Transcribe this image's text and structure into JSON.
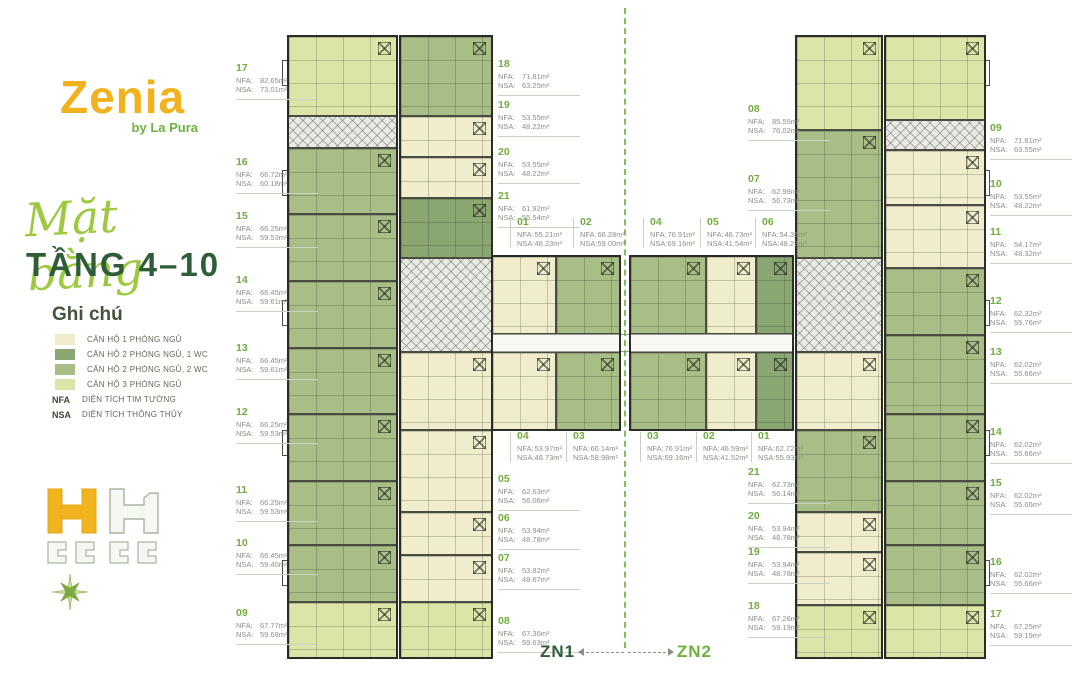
{
  "sidebar": {
    "logo": {
      "name": "Zenia",
      "byline": "by La Pura"
    },
    "title_script": "Mặt bằng",
    "title_main": "TẦNG 4–10",
    "legend": {
      "heading": "Ghi chú",
      "items": [
        {
          "label": "CĂN HỘ 1 PHÒNG NGỦ",
          "color": "#EFEDCB"
        },
        {
          "label": "CĂN HỘ 2 PHÒNG NGỦ, 1 WC",
          "color": "#8AA771"
        },
        {
          "label": "CĂN HỘ 2 PHÒNG NGỦ, 2 WC",
          "color": "#A9BE87"
        },
        {
          "label": "CĂN HỘ 3 PHÒNG NGỦ",
          "color": "#DCE4A8"
        }
      ],
      "abbreviations": [
        {
          "key": "NFA",
          "label": "DIỆN TÍCH TIM TƯỜNG"
        },
        {
          "key": "NSA",
          "label": "DIỆN TÍCH THÔNG THỦY"
        }
      ]
    }
  },
  "zones": {
    "left_label": "ZN1",
    "right_label": "ZN2"
  },
  "plan": {
    "nfa_key": "NFA:",
    "nsa_key": "NSA:",
    "unit_labels": [
      {
        "zone": "zn1",
        "id": "17",
        "nfa": "82.65m²",
        "nsa": "73.01m²",
        "x": 236,
        "y": 64,
        "s": "side"
      },
      {
        "zone": "zn1",
        "id": "16",
        "nfa": "66.72m²",
        "nsa": "60.18m²",
        "x": 236,
        "y": 158,
        "s": "side"
      },
      {
        "zone": "zn1",
        "id": "15",
        "nfa": "66.25m²",
        "nsa": "59.53m²",
        "x": 236,
        "y": 212,
        "s": "side"
      },
      {
        "zone": "zn1",
        "id": "14",
        "nfa": "66.45m²",
        "nsa": "59.61m²",
        "x": 236,
        "y": 276,
        "s": "side"
      },
      {
        "zone": "zn1",
        "id": "13",
        "nfa": "66.45m²",
        "nsa": "59.61m²",
        "x": 236,
        "y": 344,
        "s": "side"
      },
      {
        "zone": "zn1",
        "id": "12",
        "nfa": "66.25m²",
        "nsa": "59.53m²",
        "x": 236,
        "y": 408,
        "s": "side"
      },
      {
        "zone": "zn1",
        "id": "11",
        "nfa": "66.25m²",
        "nsa": "59.53m²",
        "x": 236,
        "y": 486,
        "s": "side"
      },
      {
        "zone": "zn1",
        "id": "10",
        "nfa": "66.45m²",
        "nsa": "59.40m²",
        "x": 236,
        "y": 539,
        "s": "side"
      },
      {
        "zone": "zn1",
        "id": "09",
        "nfa": "67.77m²",
        "nsa": "59.68m²",
        "x": 236,
        "y": 609,
        "s": "side"
      },
      {
        "zone": "zn1",
        "id": "18",
        "nfa": "71.81m²",
        "nsa": "63.25m²",
        "x": 498,
        "y": 60,
        "s": "side"
      },
      {
        "zone": "zn1",
        "id": "19",
        "nfa": "53.55m²",
        "nsa": "48.22m²",
        "x": 498,
        "y": 101,
        "s": "side"
      },
      {
        "zone": "zn1",
        "id": "20",
        "nfa": "53.55m²",
        "nsa": "48.22m²",
        "x": 498,
        "y": 148,
        "s": "side"
      },
      {
        "zone": "zn1",
        "id": "21",
        "nfa": "61.92m²",
        "nsa": "55.54m²",
        "x": 498,
        "y": 192,
        "s": "side"
      },
      {
        "zone": "zn1",
        "id": "01",
        "nfa": "55.21m²",
        "nsa": "48.23m²",
        "x": 510,
        "y": 218,
        "s": "center"
      },
      {
        "zone": "zn1",
        "id": "02",
        "nfa": "66.28m²",
        "nsa": "59.00m²",
        "x": 573,
        "y": 218,
        "s": "center"
      },
      {
        "zone": "zn1",
        "id": "04",
        "nfa": "53.97m²",
        "nsa": "48.73m²",
        "x": 510,
        "y": 432,
        "s": "center"
      },
      {
        "zone": "zn1",
        "id": "03",
        "nfa": "66.14m²",
        "nsa": "58.98m²",
        "x": 566,
        "y": 432,
        "s": "center"
      },
      {
        "zone": "zn1",
        "id": "05",
        "nfa": "62.63m²",
        "nsa": "56.06m²",
        "x": 498,
        "y": 475,
        "s": "side"
      },
      {
        "zone": "zn1",
        "id": "06",
        "nfa": "53.94m²",
        "nsa": "48.78m²",
        "x": 498,
        "y": 514,
        "s": "side"
      },
      {
        "zone": "zn1",
        "id": "07",
        "nfa": "53.82m²",
        "nsa": "48.67m²",
        "x": 498,
        "y": 554,
        "s": "side"
      },
      {
        "zone": "zn1",
        "id": "08",
        "nfa": "67.36m²",
        "nsa": "59.63m²",
        "x": 498,
        "y": 617,
        "s": "side"
      },
      {
        "zone": "zn2",
        "id": "04",
        "nfa": "76.91m²",
        "nsa": "69.16m²",
        "x": 643,
        "y": 218,
        "s": "center"
      },
      {
        "zone": "zn2",
        "id": "05",
        "nfa": "46.73m²",
        "nsa": "41.54m²",
        "x": 700,
        "y": 218,
        "s": "center"
      },
      {
        "zone": "zn2",
        "id": "06",
        "nfa": "54.35m²",
        "nsa": "48.23m²",
        "x": 755,
        "y": 218,
        "s": "center"
      },
      {
        "zone": "zn2",
        "id": "03",
        "nfa": "76.91m²",
        "nsa": "69.16m²",
        "x": 640,
        "y": 432,
        "s": "center"
      },
      {
        "zone": "zn2",
        "id": "02",
        "nfa": "46.59m²",
        "nsa": "41.52m²",
        "x": 696,
        "y": 432,
        "s": "center"
      },
      {
        "zone": "zn2",
        "id": "01",
        "nfa": "62.72m²",
        "nsa": "55.93m²",
        "x": 751,
        "y": 432,
        "s": "center"
      },
      {
        "zone": "zn2",
        "id": "08",
        "nfa": "85.55m²",
        "nsa": "76.02m²",
        "x": 748,
        "y": 105,
        "s": "side"
      },
      {
        "zone": "zn2",
        "id": "07",
        "nfa": "62.98m²",
        "nsa": "56.73m²",
        "x": 748,
        "y": 175,
        "s": "side"
      },
      {
        "zone": "zn2",
        "id": "21",
        "nfa": "62.73m²",
        "nsa": "56.14m²",
        "x": 748,
        "y": 468,
        "s": "side"
      },
      {
        "zone": "zn2",
        "id": "20",
        "nfa": "53.94m²",
        "nsa": "48.78m²",
        "x": 748,
        "y": 512,
        "s": "side"
      },
      {
        "zone": "zn2",
        "id": "19",
        "nfa": "53.94m²",
        "nsa": "48.78m²",
        "x": 748,
        "y": 548,
        "s": "side"
      },
      {
        "zone": "zn2",
        "id": "18",
        "nfa": "67.26m²",
        "nsa": "59.19m²",
        "x": 748,
        "y": 602,
        "s": "side"
      },
      {
        "zone": "zn2",
        "id": "09",
        "nfa": "71.81m²",
        "nsa": "63.55m²",
        "x": 990,
        "y": 124,
        "s": "side"
      },
      {
        "zone": "zn2",
        "id": "10",
        "nfa": "53.55m²",
        "nsa": "48.22m²",
        "x": 990,
        "y": 180,
        "s": "side"
      },
      {
        "zone": "zn2",
        "id": "11",
        "nfa": "54.17m²",
        "nsa": "48.32m²",
        "x": 990,
        "y": 228,
        "s": "side"
      },
      {
        "zone": "zn2",
        "id": "12",
        "nfa": "62.32m²",
        "nsa": "55.76m²",
        "x": 990,
        "y": 297,
        "s": "side"
      },
      {
        "zone": "zn2",
        "id": "13",
        "nfa": "62.02m²",
        "nsa": "55.66m²",
        "x": 990,
        "y": 348,
        "s": "side"
      },
      {
        "zone": "zn2",
        "id": "14",
        "nfa": "62.02m²",
        "nsa": "55.66m²",
        "x": 990,
        "y": 428,
        "s": "side"
      },
      {
        "zone": "zn2",
        "id": "15",
        "nfa": "62.02m²",
        "nsa": "55.66m²",
        "x": 990,
        "y": 479,
        "s": "side"
      },
      {
        "zone": "zn2",
        "id": "16",
        "nfa": "62.02m²",
        "nsa": "55.66m²",
        "x": 990,
        "y": 558,
        "s": "side"
      },
      {
        "zone": "zn2",
        "id": "17",
        "nfa": "67.25m²",
        "nsa": "59.19m²",
        "x": 990,
        "y": 610,
        "s": "side"
      }
    ],
    "blocks": [
      {
        "x": 288,
        "y": 36,
        "w": 109,
        "h": 80,
        "t": "u3"
      },
      {
        "x": 288,
        "y": 116,
        "w": 109,
        "h": 32,
        "t": "core"
      },
      {
        "x": 288,
        "y": 148,
        "w": 109,
        "h": 66,
        "t": "u2b"
      },
      {
        "x": 288,
        "y": 214,
        "w": 109,
        "h": 67,
        "t": "u2b"
      },
      {
        "x": 288,
        "y": 281,
        "w": 109,
        "h": 67,
        "t": "u2b"
      },
      {
        "x": 288,
        "y": 348,
        "w": 109,
        "h": 66,
        "t": "u2b"
      },
      {
        "x": 288,
        "y": 414,
        "w": 109,
        "h": 67,
        "t": "u2b"
      },
      {
        "x": 288,
        "y": 481,
        "w": 109,
        "h": 64,
        "t": "u2b"
      },
      {
        "x": 288,
        "y": 545,
        "w": 109,
        "h": 57,
        "t": "u2b"
      },
      {
        "x": 288,
        "y": 602,
        "w": 109,
        "h": 56,
        "t": "u3"
      },
      {
        "x": 400,
        "y": 36,
        "w": 92,
        "h": 80,
        "t": "u2b"
      },
      {
        "x": 400,
        "y": 116,
        "w": 92,
        "h": 41,
        "t": "u1"
      },
      {
        "x": 400,
        "y": 157,
        "w": 92,
        "h": 41,
        "t": "u1"
      },
      {
        "x": 400,
        "y": 198,
        "w": 92,
        "h": 60,
        "t": "u2a"
      },
      {
        "x": 400,
        "y": 258,
        "w": 92,
        "h": 94,
        "t": "core"
      },
      {
        "x": 400,
        "y": 352,
        "w": 92,
        "h": 78,
        "t": "u1"
      },
      {
        "x": 400,
        "y": 430,
        "w": 92,
        "h": 82,
        "t": "u1"
      },
      {
        "x": 400,
        "y": 512,
        "w": 92,
        "h": 43,
        "t": "u1"
      },
      {
        "x": 400,
        "y": 555,
        "w": 92,
        "h": 47,
        "t": "u1"
      },
      {
        "x": 400,
        "y": 602,
        "w": 92,
        "h": 56,
        "t": "u3"
      },
      {
        "x": 492,
        "y": 256,
        "w": 64,
        "h": 78,
        "t": "u1"
      },
      {
        "x": 556,
        "y": 256,
        "w": 64,
        "h": 78,
        "t": "u2b"
      },
      {
        "x": 492,
        "y": 334,
        "w": 128,
        "h": 18,
        "t": "corridor"
      },
      {
        "x": 492,
        "y": 352,
        "w": 64,
        "h": 78,
        "t": "u1"
      },
      {
        "x": 556,
        "y": 352,
        "w": 64,
        "h": 78,
        "t": "u2b"
      },
      {
        "x": 620,
        "y": 334,
        "w": 10,
        "h": 18,
        "t": "corridor"
      },
      {
        "x": 630,
        "y": 256,
        "w": 76,
        "h": 78,
        "t": "u2b"
      },
      {
        "x": 706,
        "y": 256,
        "w": 50,
        "h": 78,
        "t": "u1"
      },
      {
        "x": 756,
        "y": 256,
        "w": 37,
        "h": 78,
        "t": "u2a"
      },
      {
        "x": 630,
        "y": 334,
        "w": 163,
        "h": 18,
        "t": "corridor"
      },
      {
        "x": 630,
        "y": 352,
        "w": 76,
        "h": 78,
        "t": "u2b"
      },
      {
        "x": 706,
        "y": 352,
        "w": 50,
        "h": 78,
        "t": "u1"
      },
      {
        "x": 756,
        "y": 352,
        "w": 37,
        "h": 78,
        "t": "u2a"
      },
      {
        "x": 796,
        "y": 36,
        "w": 86,
        "h": 94,
        "t": "u3"
      },
      {
        "x": 796,
        "y": 130,
        "w": 86,
        "h": 128,
        "t": "u2b"
      },
      {
        "x": 796,
        "y": 258,
        "w": 86,
        "h": 94,
        "t": "core"
      },
      {
        "x": 796,
        "y": 352,
        "w": 86,
        "h": 78,
        "t": "u1"
      },
      {
        "x": 796,
        "y": 430,
        "w": 86,
        "h": 82,
        "t": "u2b"
      },
      {
        "x": 796,
        "y": 512,
        "w": 86,
        "h": 40,
        "t": "u1"
      },
      {
        "x": 796,
        "y": 552,
        "w": 86,
        "h": 53,
        "t": "u1"
      },
      {
        "x": 796,
        "y": 605,
        "w": 86,
        "h": 53,
        "t": "u3"
      },
      {
        "x": 885,
        "y": 36,
        "w": 100,
        "h": 84,
        "t": "u3"
      },
      {
        "x": 885,
        "y": 120,
        "w": 100,
        "h": 30,
        "t": "core"
      },
      {
        "x": 885,
        "y": 150,
        "w": 100,
        "h": 55,
        "t": "u1"
      },
      {
        "x": 885,
        "y": 205,
        "w": 100,
        "h": 63,
        "t": "u1"
      },
      {
        "x": 885,
        "y": 268,
        "w": 100,
        "h": 67,
        "t": "u2b"
      },
      {
        "x": 885,
        "y": 335,
        "w": 100,
        "h": 79,
        "t": "u2b"
      },
      {
        "x": 885,
        "y": 414,
        "w": 100,
        "h": 67,
        "t": "u2b"
      },
      {
        "x": 885,
        "y": 481,
        "w": 100,
        "h": 64,
        "t": "u2b"
      },
      {
        "x": 885,
        "y": 545,
        "w": 100,
        "h": 60,
        "t": "u2b"
      },
      {
        "x": 885,
        "y": 605,
        "w": 100,
        "h": 53,
        "t": "u3"
      },
      {
        "x": 282,
        "y": 60,
        "w": 6,
        "h": 26,
        "t": "balc"
      },
      {
        "x": 282,
        "y": 170,
        "w": 6,
        "h": 26,
        "t": "balc"
      },
      {
        "x": 282,
        "y": 300,
        "w": 6,
        "h": 26,
        "t": "balc"
      },
      {
        "x": 282,
        "y": 430,
        "w": 6,
        "h": 26,
        "t": "balc"
      },
      {
        "x": 282,
        "y": 560,
        "w": 6,
        "h": 26,
        "t": "balc"
      },
      {
        "x": 984,
        "y": 60,
        "w": 6,
        "h": 26,
        "t": "balc"
      },
      {
        "x": 984,
        "y": 170,
        "w": 6,
        "h": 26,
        "t": "balc"
      },
      {
        "x": 984,
        "y": 300,
        "w": 6,
        "h": 26,
        "t": "balc"
      },
      {
        "x": 984,
        "y": 430,
        "w": 6,
        "h": 26,
        "t": "balc"
      },
      {
        "x": 984,
        "y": 560,
        "w": 6,
        "h": 26,
        "t": "balc"
      },
      {
        "x": 287,
        "y": 35,
        "w": 111,
        "h": 624,
        "t": "outline"
      },
      {
        "x": 399,
        "y": 35,
        "w": 94,
        "h": 624,
        "t": "outline"
      },
      {
        "x": 795,
        "y": 35,
        "w": 88,
        "h": 624,
        "t": "outline"
      },
      {
        "x": 884,
        "y": 35,
        "w": 102,
        "h": 624,
        "t": "outline"
      },
      {
        "x": 491,
        "y": 255,
        "w": 130,
        "h": 176,
        "t": "outline"
      },
      {
        "x": 629,
        "y": 255,
        "w": 165,
        "h": 176,
        "t": "outline"
      }
    ]
  },
  "colors": {
    "accent_yellow": "#F2B21D",
    "green_bright": "#6CB340",
    "green_dark": "#2E5D37",
    "green_script": "#9CC93F",
    "uid_green": "#6FAE3E",
    "text_gray": "#8A9086",
    "line_gray": "#CBD0C4",
    "legend_text": "#5F6A57",
    "u1": "#EFEDCB",
    "u2a": "#8AA771",
    "u2b": "#A9BE87",
    "u3": "#DCE4A8",
    "core_bg": "#EAEAE5",
    "corridor": "#F8F8F5",
    "wall": "#2B2B28"
  }
}
